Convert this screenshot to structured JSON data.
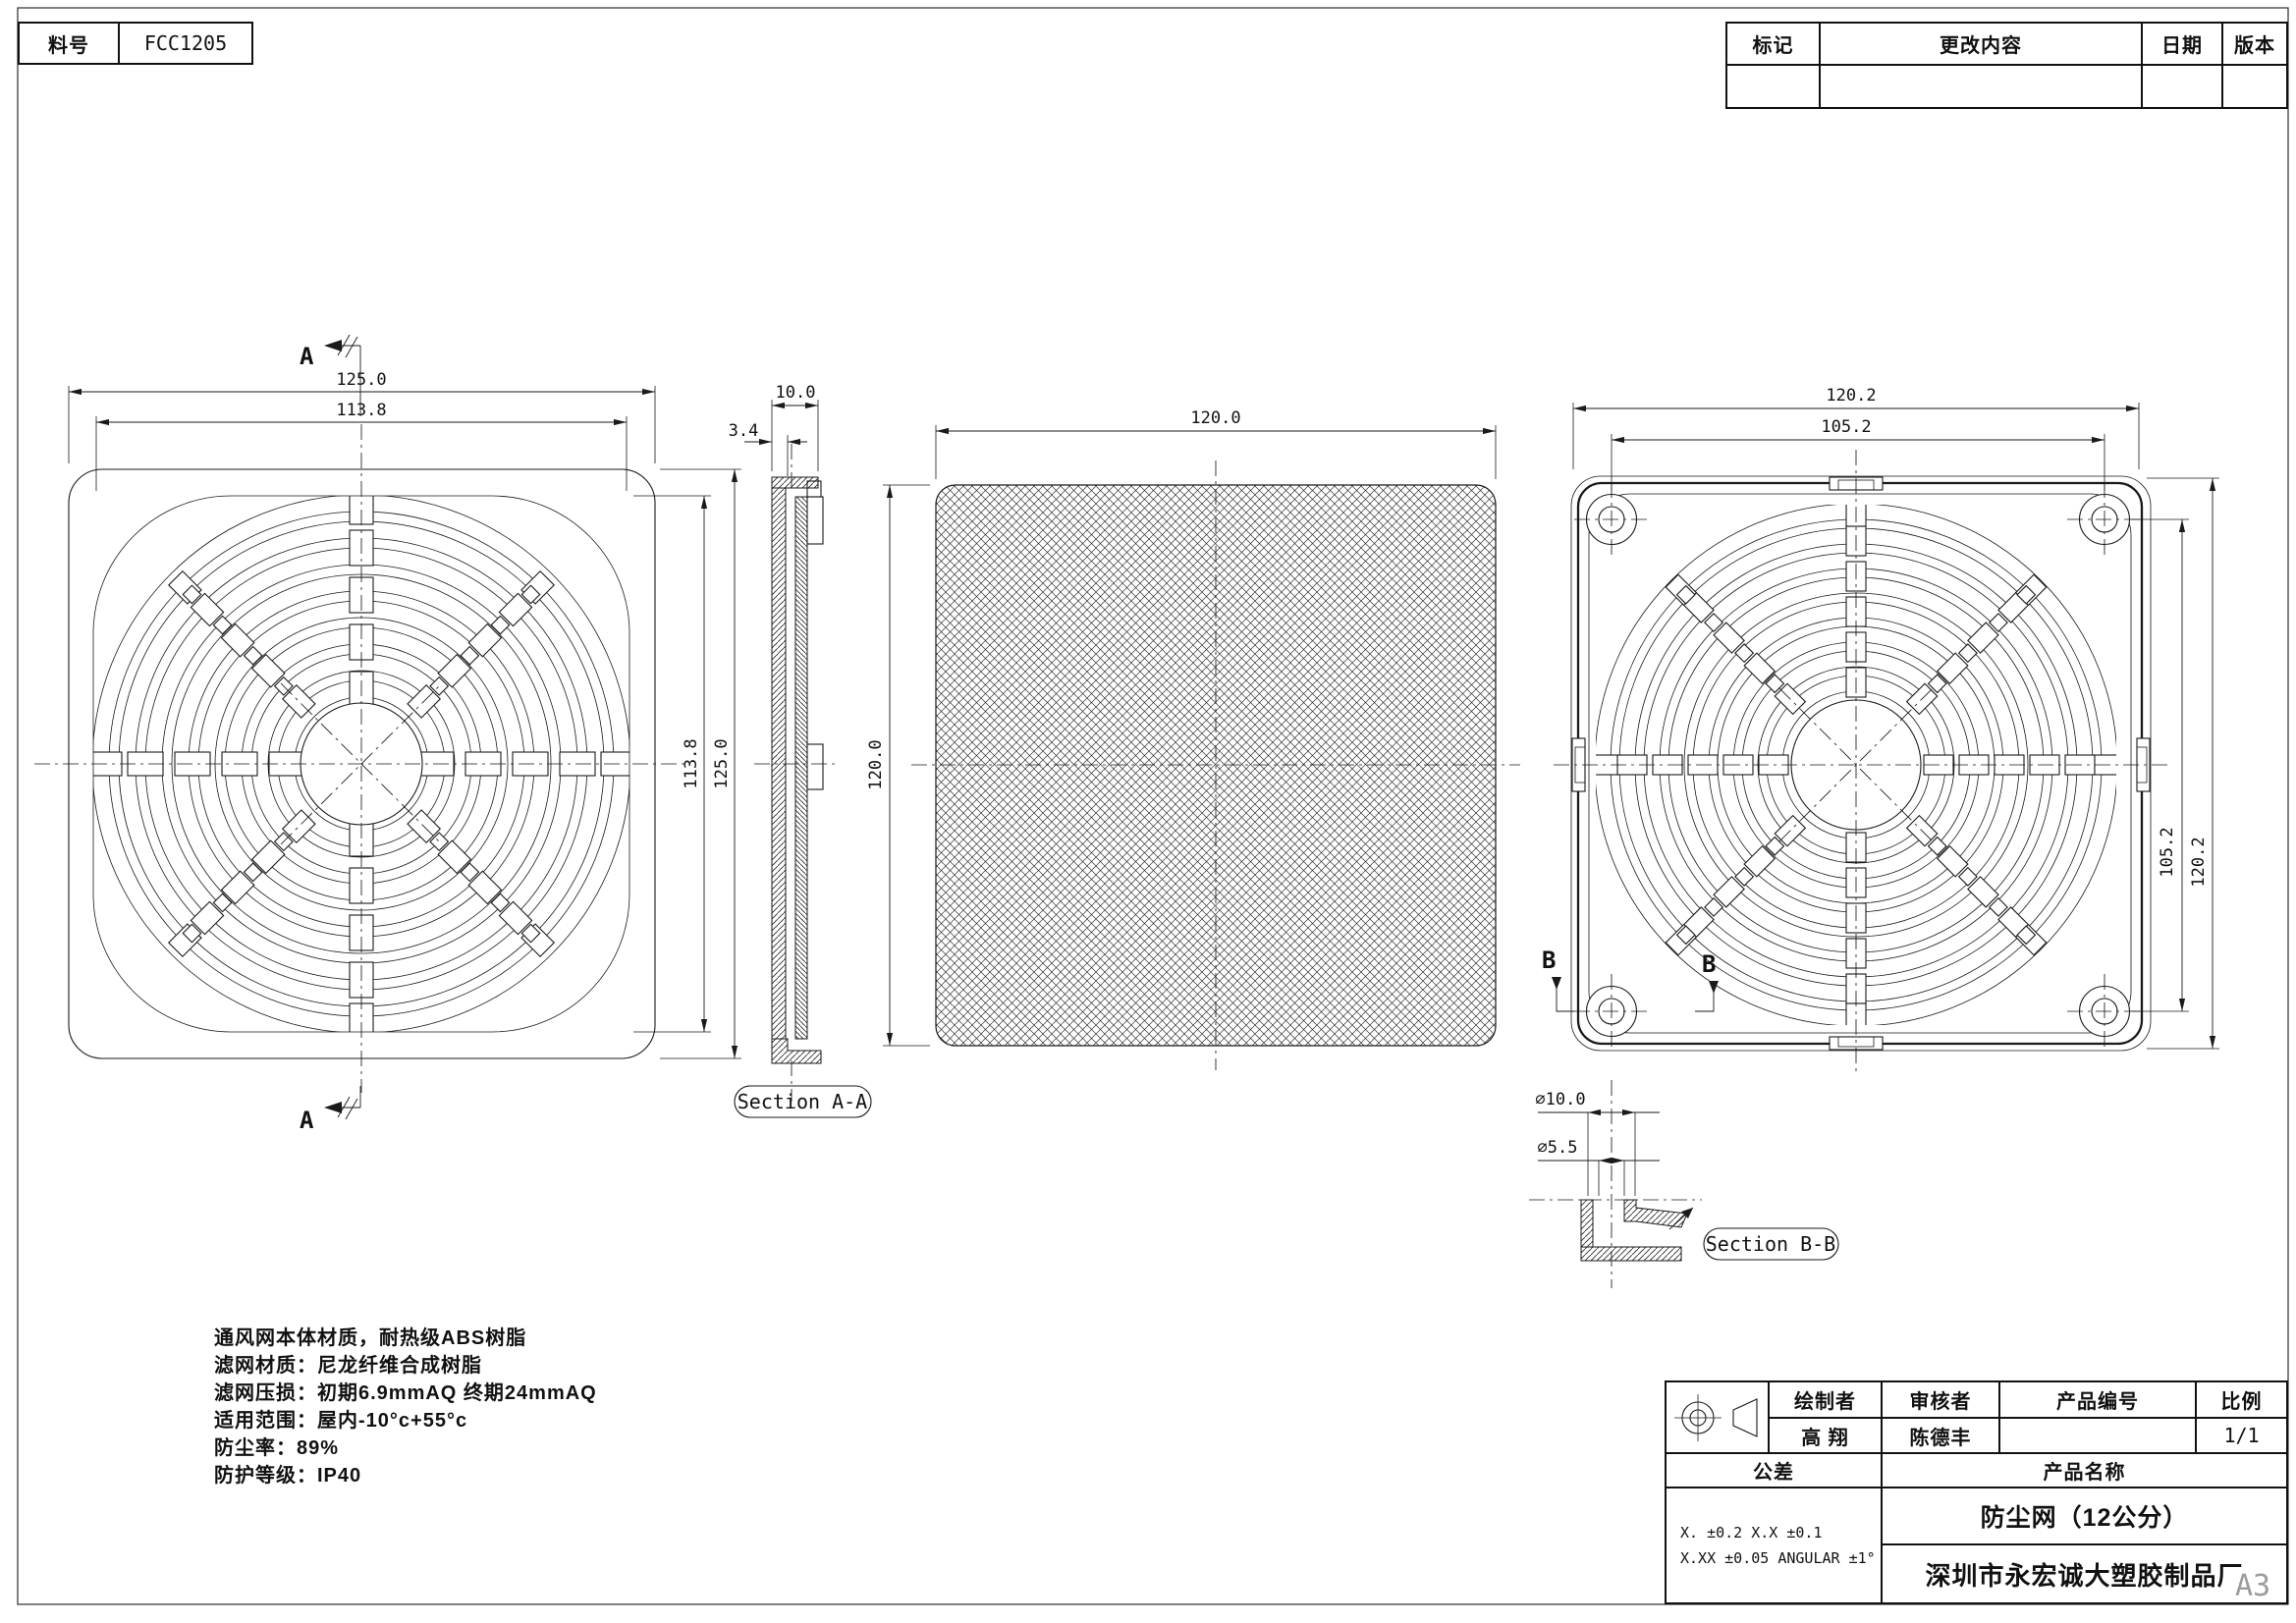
{
  "sheet": {
    "size": "A3"
  },
  "part": {
    "label": "料号",
    "value": "FCC1205"
  },
  "revision": {
    "headers": [
      "标记",
      "更改内容",
      "日期",
      "版本"
    ]
  },
  "markers": {
    "a": "A",
    "b": "B"
  },
  "labels": {
    "section_a": "Section A-A",
    "section_b": "Section B-B"
  },
  "dims": {
    "front_w": "125.0",
    "front_iw": "113.8",
    "front_h": "125.0",
    "front_ih": "113.8",
    "sec_a_total": "10.0",
    "sec_a_frame": "3.4",
    "mesh_w": "120.0",
    "mesh_h": "120.0",
    "back_w": "120.2",
    "back_iw": "105.2",
    "back_h": "120.2",
    "back_ih": "105.2",
    "sec_b_outer": "⌀10.0",
    "sec_b_inner": "⌀5.5"
  },
  "notes": [
    "通风网本体材质，耐热级ABS树脂",
    "滤网材质：尼龙纤维合成树脂",
    "滤网压损：初期6.9mmAQ  终期24mmAQ",
    "适用范围：屋内-10°c+55°c",
    "防尘率：89%",
    "防护等级：IP40"
  ],
  "title_block": {
    "drafter_label": "绘制者",
    "reviewer_label": "审核者",
    "product_no_label": "产品编号",
    "scale_label": "比例",
    "drafter": "高 翔",
    "reviewer": "陈德丰",
    "product_no": "",
    "scale": "1/1",
    "tolerance_label": "公差",
    "product_name_label": "产品名称",
    "product_name": "防尘网（12公分）",
    "company": "深圳市永宏诚大塑胶制品厂",
    "tol1": "X.    ±0.2      X.X     ±0.1",
    "tol2": "X.XX  ±0.05   ANGULAR  ±1°"
  }
}
